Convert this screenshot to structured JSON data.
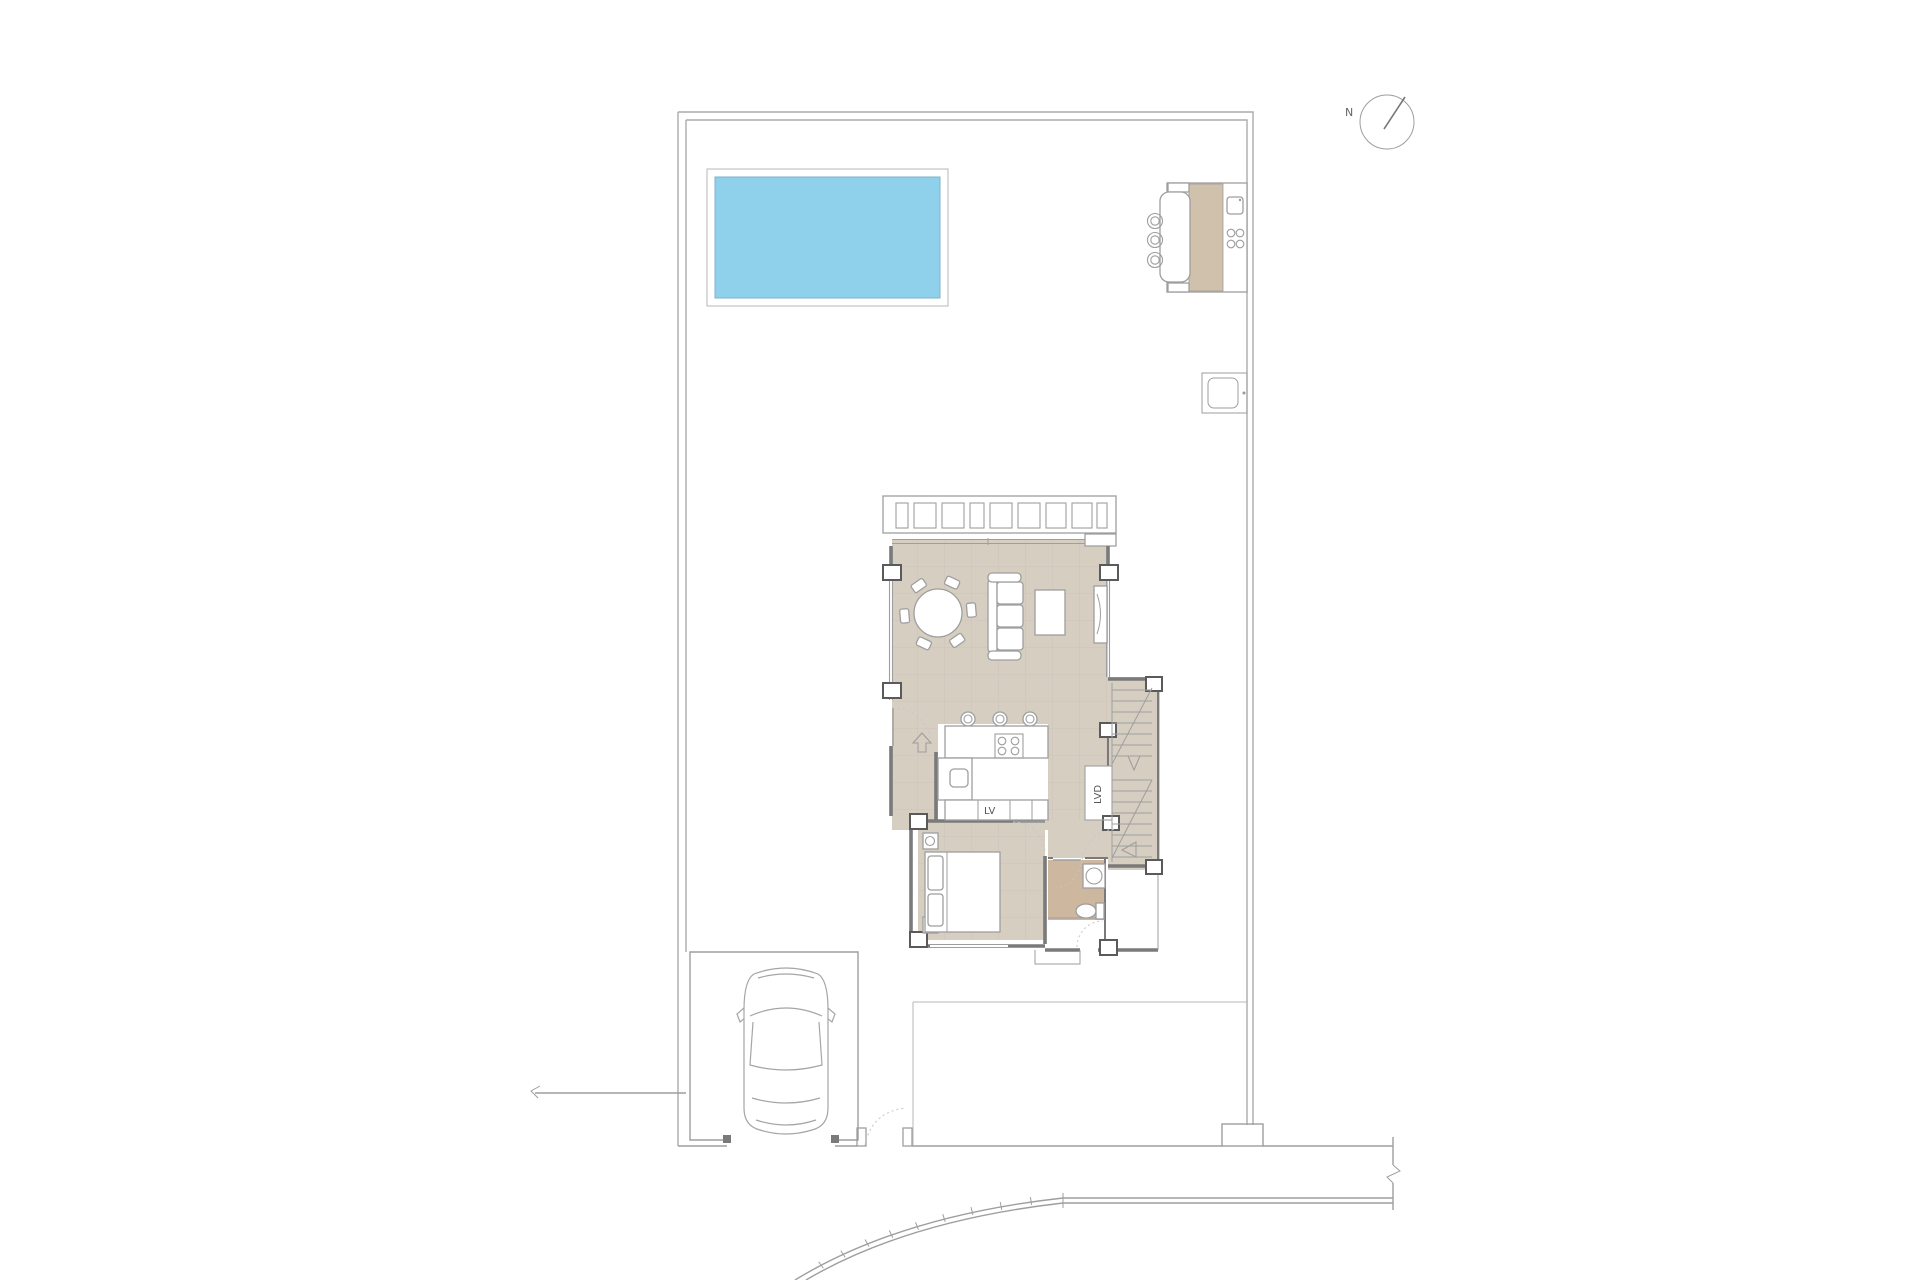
{
  "title": "Villa ground floor site plan",
  "labels": {
    "north": "N",
    "dishwasher": "LV",
    "laundry": "LVD"
  },
  "colors": {
    "pool": "#8fd1ea",
    "pool_border": "#7fb3c8",
    "floor": "#d7cec2",
    "floor_dark": "#cdb79f",
    "kitchen_strip": "#cfc1ac",
    "wall": "#7a7a7a",
    "pillar": "#5a5a5a",
    "line": "#9e9e9e",
    "line_light": "#b7b7b7",
    "boundary": "#ababab",
    "dash": "#c6c6c6",
    "background": "#ffffff"
  }
}
